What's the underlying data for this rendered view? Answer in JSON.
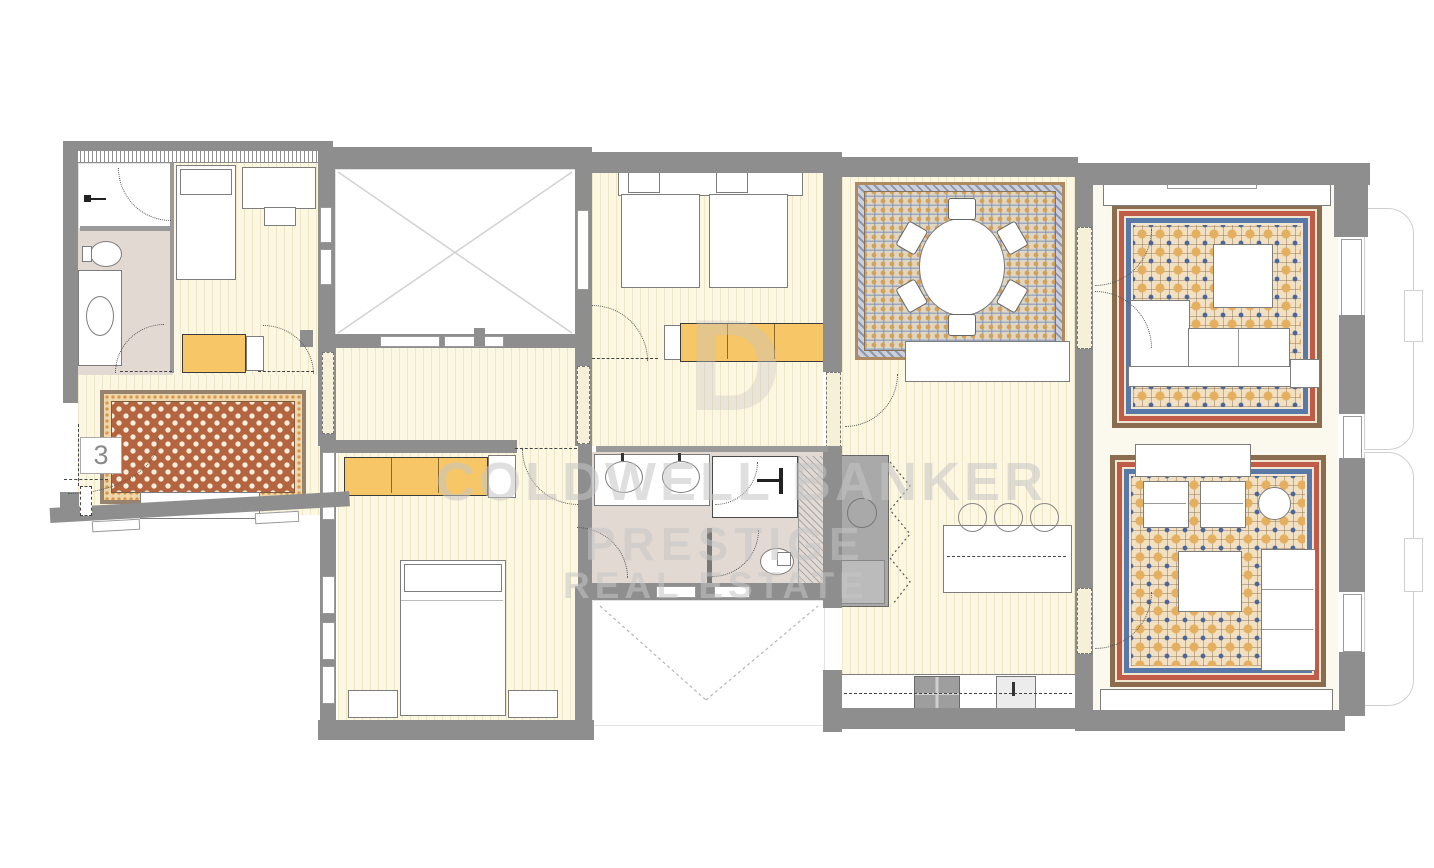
{
  "plan": {
    "unit_label": "3"
  },
  "watermark": {
    "monogram": "D",
    "line1": "COLDWELL BANKER",
    "line2": "PRESTIGE",
    "line3": "REAL ESTATE"
  },
  "colors": {
    "wall": "#8e8e8e",
    "wallLight": "#9a9a9a",
    "floor": "#fcf7e2",
    "stripe": "#efe6c4",
    "bath": "#e2d9d3",
    "yellow": "#f6c667",
    "outline": "#7d7d7d",
    "rugRedField": "#b4653f",
    "rugRedStar": "#f7eedd",
    "rugRedBand": "#eed8ab",
    "rugRedBorder": "#97826d",
    "rugRedDot": "#d9984d",
    "dinField": "#ded6c5",
    "dinDot": "#d4a055",
    "dinBorder": "#b08a62",
    "dinZig": "#ccd0db",
    "livField": "#f1e0c1",
    "livCircle": "#e5af60",
    "livStar": "#4a659a",
    "livGrid": "#8a6c4e",
    "livBlue": "#5878a8",
    "livRed": "#c05b47",
    "livCream": "#f1e6d2",
    "kitchenUnit": "#a9a9a9",
    "watermark": "#c6c6c6",
    "dash": "#444444",
    "patioLine": "#d2d2d2"
  }
}
